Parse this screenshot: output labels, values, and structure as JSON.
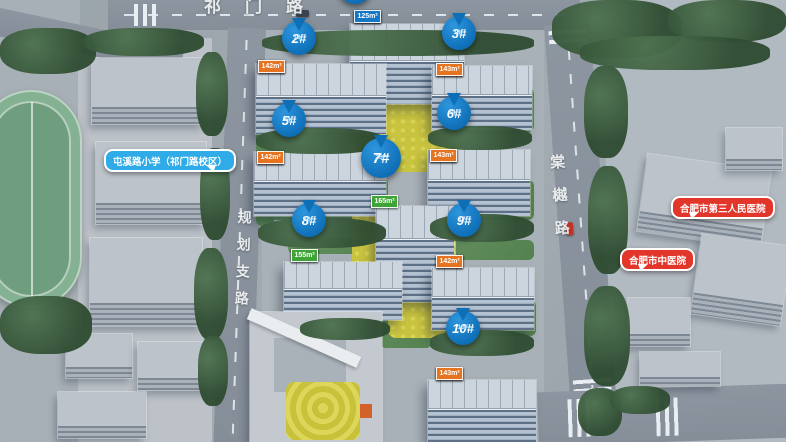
{
  "roads": {
    "top": "祁门路",
    "left": "规划支路",
    "right": "棠樾路"
  },
  "pois": [
    {
      "key": "school",
      "type": "school",
      "label": "屯溪路小学（祁门路校区）"
    },
    {
      "key": "hospital-third",
      "type": "hospital",
      "label": "合肥市第三人民医院"
    },
    {
      "key": "hospital-tcm",
      "type": "hospital",
      "label": "合肥市中医院"
    }
  ],
  "buildings": [
    {
      "id": "1",
      "pin": null,
      "floors": null,
      "units": [
        {
          "area": "125m²",
          "c": "blue"
        },
        {
          "area": "165m²",
          "c": "green"
        },
        {
          "area": "165m²",
          "c": "green"
        },
        {
          "area": "125m²",
          "c": "blue"
        }
      ]
    },
    {
      "id": "2",
      "pin": "2#",
      "floors": "18F",
      "units": [
        {
          "area": "143m²",
          "c": "orange"
        },
        {
          "area": "121m²",
          "c": "blue"
        },
        {
          "area": "128m²",
          "c": "blue"
        },
        {
          "area": "142m²",
          "c": "orange"
        }
      ]
    },
    {
      "id": "3",
      "pin": "3#",
      "floors": "18F",
      "units": [
        {
          "area": "143m²",
          "c": "orange"
        },
        {
          "area": "125m²",
          "c": "blue"
        },
        {
          "area": "125m²",
          "c": "blue"
        },
        {
          "area": "143m²",
          "c": "orange"
        }
      ]
    },
    {
      "id": "5",
      "pin": "5#",
      "floors": "34F",
      "units": [
        {
          "area": "143m²",
          "c": "orange"
        },
        {
          "area": "125m²",
          "c": "blue"
        },
        {
          "area": "125m²",
          "c": "blue"
        },
        {
          "area": "142m²",
          "c": "orange"
        }
      ]
    },
    {
      "id": "6",
      "pin": "6#",
      "floors": "34F",
      "units": [
        {
          "area": "143m²",
          "c": "orange"
        },
        {
          "area": "125m²",
          "c": "blue"
        },
        {
          "area": "125m²",
          "c": "blue"
        },
        {
          "area": "143m²",
          "c": "orange"
        }
      ]
    },
    {
      "id": "7",
      "pin": "7#",
      "floors": "26F",
      "units": [
        {
          "area": "165m²",
          "c": "green"
        },
        {
          "area": "165m²",
          "c": "green"
        }
      ]
    },
    {
      "id": "8",
      "pin": "8#",
      "floors": "10F",
      "units": [
        {
          "area": "168m²",
          "c": "green"
        },
        {
          "area": "168m²",
          "c": "green"
        },
        {
          "area": "155m²",
          "c": "green"
        }
      ]
    },
    {
      "id": "9",
      "pin": "9#",
      "floors": "17F",
      "units": [
        {
          "area": "143m²",
          "c": "orange"
        },
        {
          "area": "121m²",
          "c": "blue"
        },
        {
          "area": "125m²",
          "c": "blue"
        },
        {
          "area": "142m²",
          "c": "orange"
        }
      ]
    },
    {
      "id": "10",
      "pin": "10#",
      "floors": "10F",
      "units": [
        {
          "area": "143m²",
          "c": "orange"
        },
        {
          "area": "143m²",
          "c": "orange"
        },
        {
          "area": "143m²",
          "c": "orange"
        },
        {
          "area": "143m²",
          "c": "orange"
        }
      ]
    }
  ],
  "palette": {
    "pin_blue": "#0f74c0",
    "tag_orange": "#e5731f",
    "tag_blue": "#1377c8",
    "tag_green": "#3ea435",
    "poi_blue": "#2fabe8",
    "poi_red": "#e3362b"
  }
}
